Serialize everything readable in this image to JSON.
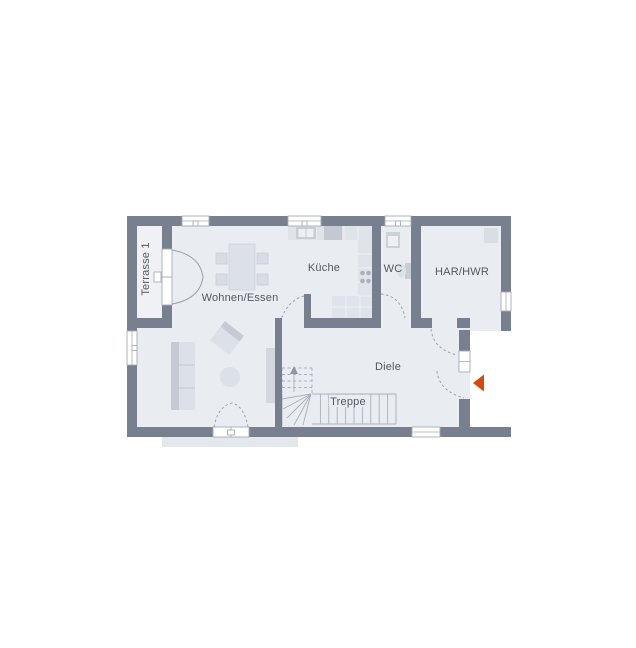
{
  "floorplan": {
    "rooms": {
      "terrace": {
        "label": "Terrasse 1"
      },
      "living_dining": {
        "label": "Wohnen/Essen"
      },
      "kitchen": {
        "label": "Küche"
      },
      "wc": {
        "label": "WC"
      },
      "har_hwr": {
        "label": "HAR/HWR"
      },
      "hallway": {
        "label": "Diele"
      },
      "stairs": {
        "label": "Treppe"
      }
    },
    "colors": {
      "wall": "#78808f",
      "floor": "#e9ecf1",
      "terrace_floor": "#eff1f5",
      "entry_floor": "#ffffff",
      "outdoor_pad": "#e4e7ec",
      "furniture": "#dce0e7",
      "furniture_dark": "#c5cad3",
      "counter": "#dfe3ea",
      "entrance_arrow": "#d8490c",
      "label_text": "#54595f",
      "line": "#9aa2ae"
    }
  }
}
